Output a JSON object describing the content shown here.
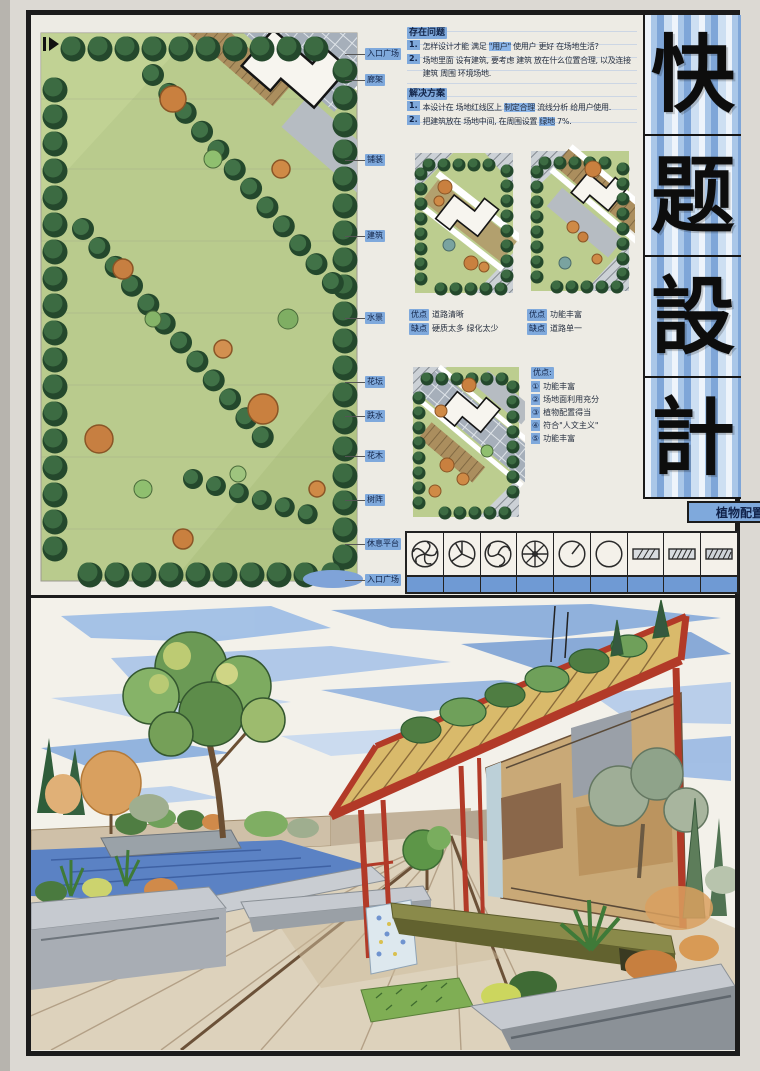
{
  "title_block": {
    "chars": [
      "快",
      "题",
      "設",
      "計"
    ],
    "stripe_color": "#7fa6d8"
  },
  "problems": {
    "header": "存在问题",
    "items": [
      {
        "num": "1.",
        "pre": "怎样设计才能 满足 ",
        "hl": "\"用户\"",
        "post": " 使用户 更好 在场地生活?"
      },
      {
        "num": "2.",
        "pre": "场地里面 设有建筑, 要考虑 建筑 放在什么位置合理, 以及连接建筑 周围 环境场地.",
        "hl": "",
        "post": ""
      }
    ]
  },
  "solutions": {
    "header": "解决方案",
    "items": [
      {
        "num": "1.",
        "pre": "本设计在 场地红线区上 ",
        "hl": "制定合理",
        "post": " 流线分析 给用户使用."
      },
      {
        "num": "2.",
        "pre": "把建筑放在 场地中间, 在周围设置 ",
        "hl": "绿地",
        "post": " 7%."
      }
    ]
  },
  "plan_labels": [
    "入口广场",
    "廊架",
    "铺装",
    "建筑",
    "水景",
    "花坛",
    "跌水",
    "花木",
    "树阵",
    "休息平台",
    "入口广场"
  ],
  "diagram_notes": {
    "d1": {
      "pros_label": "优点",
      "pros": "道路清晰",
      "cons_label": "缺点",
      "cons": "硬质太多 绿化太少"
    },
    "d2": {
      "pros_label": "优点",
      "pros": "功能丰富",
      "cons_label": "缺点",
      "cons": "道路单一"
    },
    "d3": {
      "header": "优点:",
      "items": [
        {
          "n": "①",
          "t": "功能丰富"
        },
        {
          "n": "②",
          "t": "场地面利用充分"
        },
        {
          "n": "③",
          "t": "植物配置得当"
        },
        {
          "n": "④",
          "t": "符合\"人文主义\""
        },
        {
          "n": "⑤",
          "t": "功能丰富"
        }
      ]
    }
  },
  "plant_table": {
    "title": "植物配置表",
    "symbols": [
      "fan-circle-tree",
      "segment-circle-tree",
      "swirl-circle-tree",
      "spoke-circle-tree",
      "clock-circle-tree",
      "plain-circle-tree",
      "hatch-rect-hedge",
      "hatch-rect-hedge",
      "hatch-rect-hedge"
    ]
  },
  "colors": {
    "label_blue": "#7fa9dc",
    "tree_green": "#2f5d39",
    "lawn_green": "#b9cb8d",
    "paving_gray": "#b6bcc2",
    "water_blue": "#5b82c4",
    "pavilion_red": "#b23a28",
    "wood_tan": "#d9ba6b",
    "sky_blue": "#86abdb"
  }
}
